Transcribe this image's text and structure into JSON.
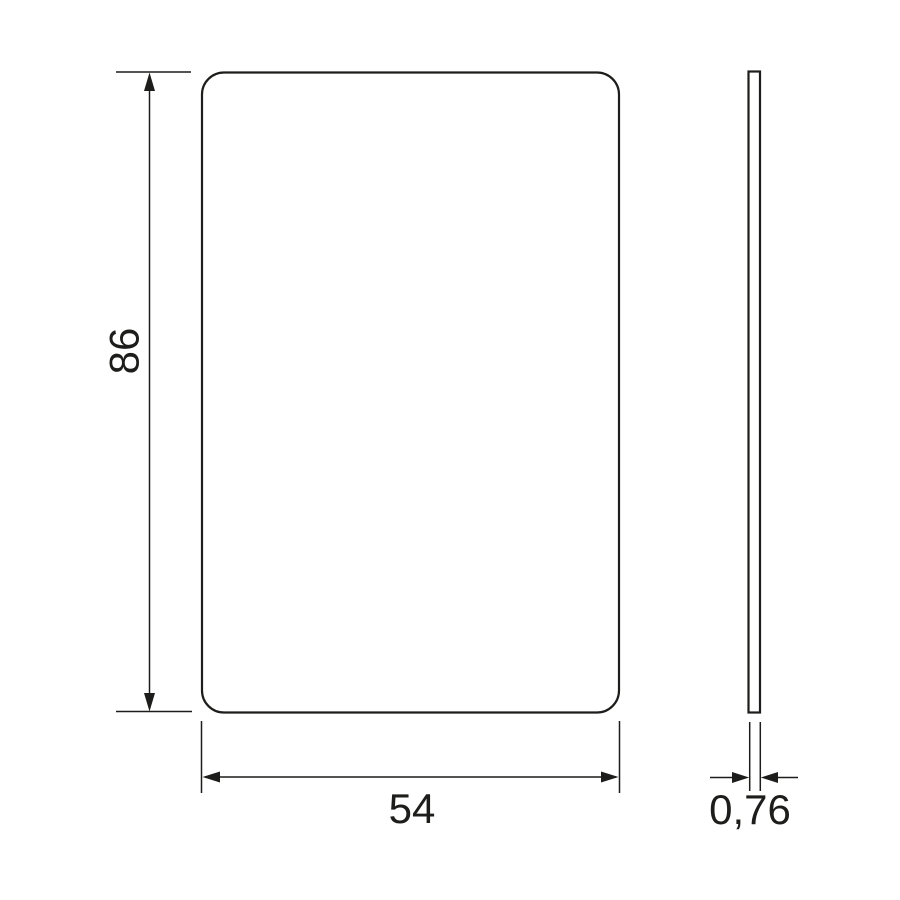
{
  "colors": {
    "line": "#1d1d1b",
    "text": "#1d1d1b",
    "background": "#ffffff"
  },
  "drawing": {
    "dimensions": {
      "height": {
        "label": "86"
      },
      "width": {
        "label": "54"
      },
      "thickness": {
        "label": "0,76"
      }
    }
  }
}
